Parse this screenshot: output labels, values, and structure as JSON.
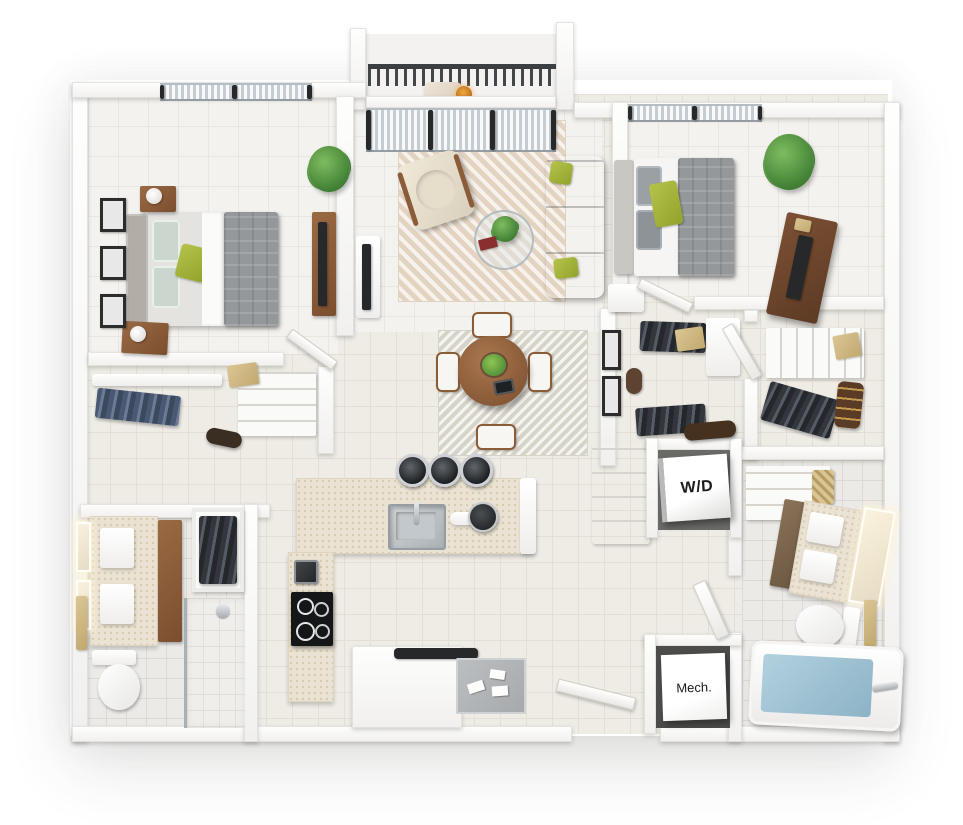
{
  "scene": {
    "labels": {
      "washer_dryer": "W/D",
      "mechanical": "Mech."
    }
  },
  "palette": {
    "background": "#ffffff",
    "wall_white": "#f6f5f3",
    "wall_shadow": "#d9d7d3",
    "floor_tile_beige": "#efece6",
    "floor_tile_light": "#f4f2ee",
    "floor_tile_bath": "#eceae7",
    "countertop_beige": "#eae3d3",
    "sofa_gray": "#8f9397",
    "bed_duvet_gray": "#94989b",
    "accent_pillow_green": "#a4b339",
    "plant_green": "#4f9441",
    "wood_medium": "#9a6a43",
    "wood_dark": "#6f4730",
    "railing_charcoal": "#3e4144",
    "appliance_black": "#26282a",
    "tub_water_blue": "#9cc3d5",
    "rug_beige": "#ecdfd0",
    "label_text": "#1b1b1b"
  },
  "rooms": [
    {
      "name": "balcony",
      "features": [
        "dark-railing",
        "lounge-chair",
        "sliding-glass-door"
      ]
    },
    {
      "name": "bedroom-1",
      "features": [
        "bed",
        "two-nightstands",
        "three-wall-frames",
        "windows",
        "tv-console",
        "plant"
      ]
    },
    {
      "name": "living-room",
      "features": [
        "gray-sofa",
        "armchair",
        "round-coffee-table",
        "herringbone-rug",
        "tv-console"
      ]
    },
    {
      "name": "dining-area",
      "features": [
        "round-wood-table",
        "four-chairs",
        "square-rug",
        "fruit-bowl"
      ]
    },
    {
      "name": "bedroom-2",
      "features": [
        "bed",
        "dresser-with-tv",
        "nightstand",
        "window",
        "plant"
      ]
    },
    {
      "name": "walk-in-closet-left",
      "features": [
        "hanging-clothes",
        "shelf",
        "storage-box"
      ]
    },
    {
      "name": "walk-in-closet-a",
      "features": [
        "hanging-clothes",
        "storage-box",
        "ottoman"
      ]
    },
    {
      "name": "walk-in-closet-b",
      "features": [
        "hanging-clothes",
        "shelving",
        "storage-box",
        "bench"
      ]
    },
    {
      "name": "kitchen",
      "features": [
        "l-shaped-counter",
        "sink",
        "three-bar-stools",
        "range-cooktop",
        "coffee-maker"
      ]
    },
    {
      "name": "laundry-closet",
      "features": [
        "washer-dryer-unit"
      ]
    },
    {
      "name": "mechanical-closet",
      "features": [
        "mechanical-panel"
      ]
    },
    {
      "name": "bathroom-1",
      "features": [
        "double-vanity",
        "lighted-mirrors",
        "toilet",
        "walk-in-shower",
        "clothes-closet",
        "towel-bar"
      ]
    },
    {
      "name": "bathroom-2",
      "features": [
        "double-vanity",
        "lighted-mirror",
        "toilet",
        "bathtub",
        "linen-shelves",
        "basket",
        "towel-bar"
      ]
    },
    {
      "name": "entry",
      "features": [
        "open-door",
        "doormat",
        "mail-envelopes",
        "wall-shelf"
      ]
    }
  ]
}
